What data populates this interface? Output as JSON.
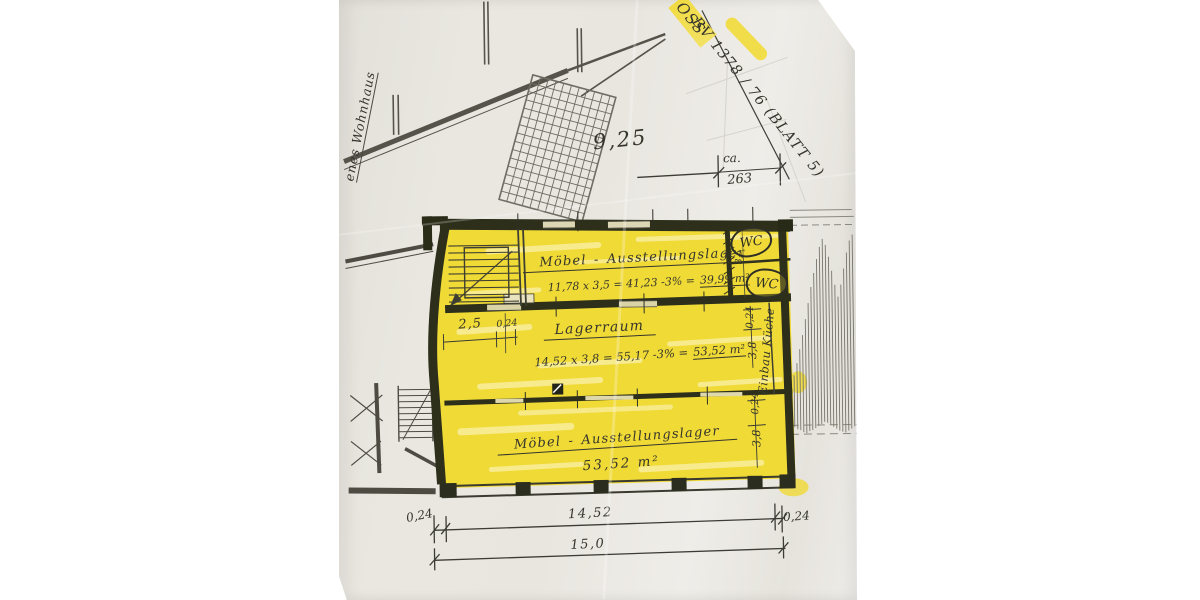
{
  "colors": {
    "highlight": "#f0da36",
    "wall": "#2d2f1b",
    "ink": "#3a3a33",
    "paper": "#e9e6e0"
  },
  "stamp": {
    "oss": "OSS",
    "bv": "BV 1378 / 76  (BLATT 5)"
  },
  "left_note": {
    "label": "enes Wohnhaus"
  },
  "top_dim": {
    "value": "9,25",
    "ca": "ca.",
    "meters": "263"
  },
  "rooms": {
    "top": {
      "name": "Möbel - Ausstellungslager",
      "formula": "11,78 x 3,5 = 41,23 -3% =",
      "result": "39,99 m²"
    },
    "middle": {
      "name": "Lagerraum",
      "formula": "14,52 x 3,8 = 55,17 -3% =",
      "result": "53,52 m²"
    },
    "bottom": {
      "name": "Möbel - Ausstellungslager",
      "area": "53,52 m²"
    }
  },
  "wc": {
    "label1": "WC",
    "label2": "WC",
    "dim": "3,5"
  },
  "stair_dims": {
    "width": "2,5",
    "wall": "0,24"
  },
  "right_dims": {
    "wall_top": "0,24",
    "depth_top": "3,8",
    "note": "Einbau Küche",
    "wall_bottom": "0,24",
    "depth_bottom": "3,8"
  },
  "bottom_dims": {
    "left_wall": "0,24",
    "inner": "14,52",
    "right_wall": "0,24",
    "total": "15,0"
  }
}
